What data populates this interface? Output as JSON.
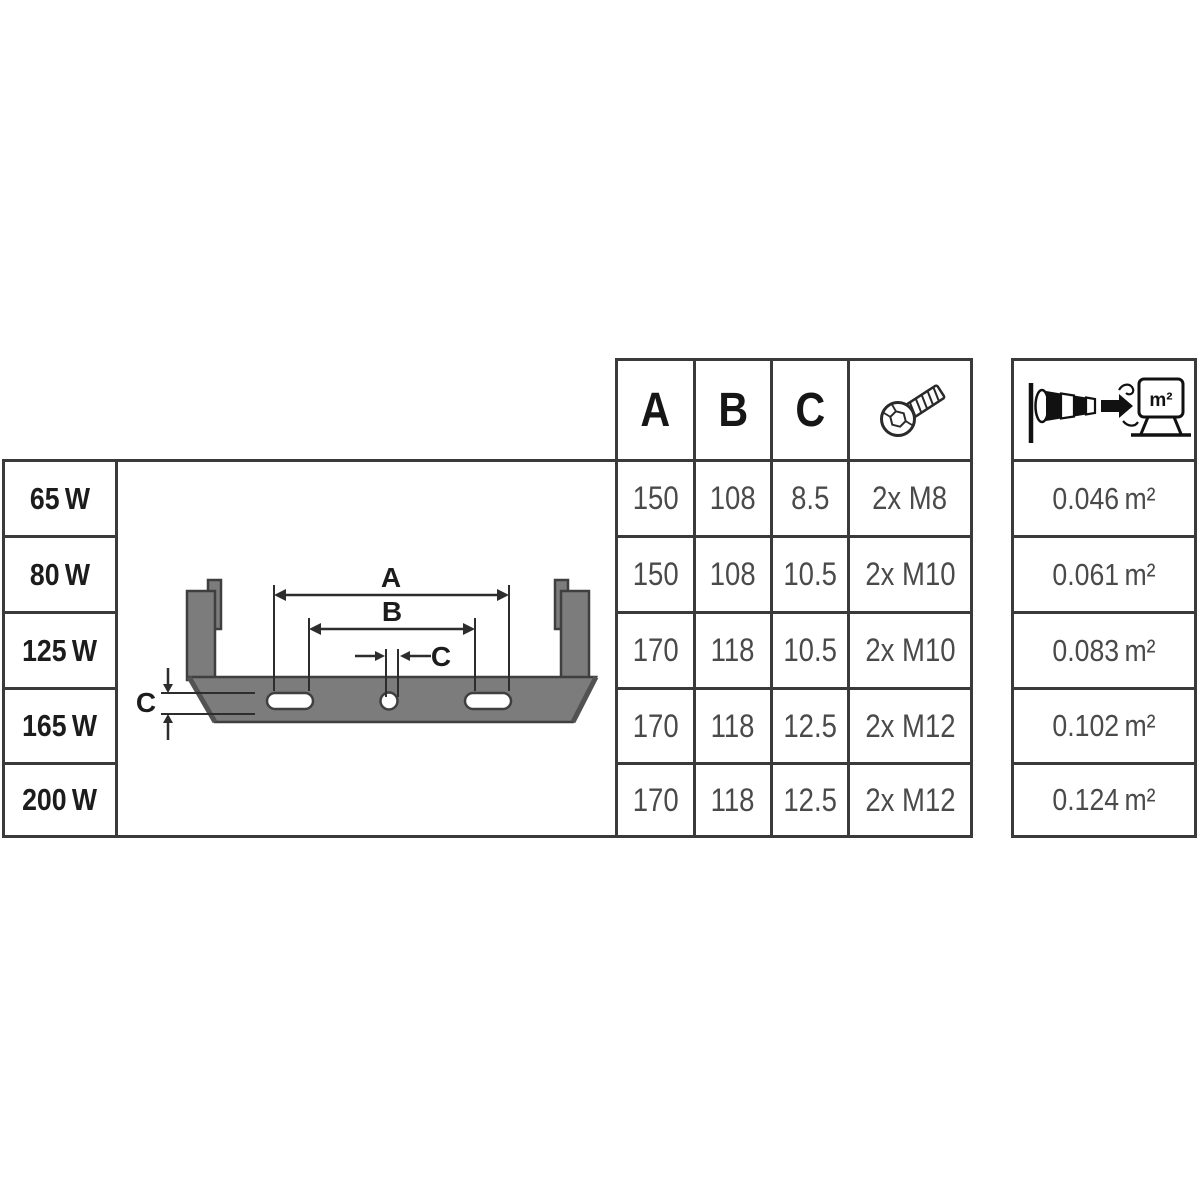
{
  "header": {
    "col_a": "A",
    "col_b": "B",
    "col_c": "C",
    "screw_icon": "cylinder-head-screw",
    "wind_icon": "windsock-wind-load-on-floodlight",
    "wind_unit_label": "m²"
  },
  "diagram": {
    "dim_a": "A",
    "dim_b": "B",
    "dim_c_hole": "C",
    "dim_c_thickness": "C"
  },
  "rows": [
    {
      "power": "65 W",
      "a": "150",
      "b": "108",
      "c": "8.5",
      "screws": "2x M8",
      "wind_area": "0.046 m²"
    },
    {
      "power": "80 W",
      "a": "150",
      "b": "108",
      "c": "10.5",
      "screws": "2x M10",
      "wind_area": "0.061 m²"
    },
    {
      "power": "125 W",
      "a": "170",
      "b": "118",
      "c": "10.5",
      "screws": "2x M10",
      "wind_area": "0.083 m²"
    },
    {
      "power": "165 W",
      "a": "170",
      "b": "118",
      "c": "12.5",
      "screws": "2x M12",
      "wind_area": "0.102 m²"
    },
    {
      "power": "200 W",
      "a": "170",
      "b": "118",
      "c": "12.5",
      "screws": "2x M12",
      "wind_area": "0.124 m²"
    }
  ],
  "colors": {
    "border": "#3a3a3a",
    "grid_text": "#4a4a4a",
    "label_text": "#1c1c1c",
    "bracket_fill": "#7c7c7c",
    "bracket_stroke": "#3f3f3f",
    "dimension_line": "#2d2d2d"
  }
}
